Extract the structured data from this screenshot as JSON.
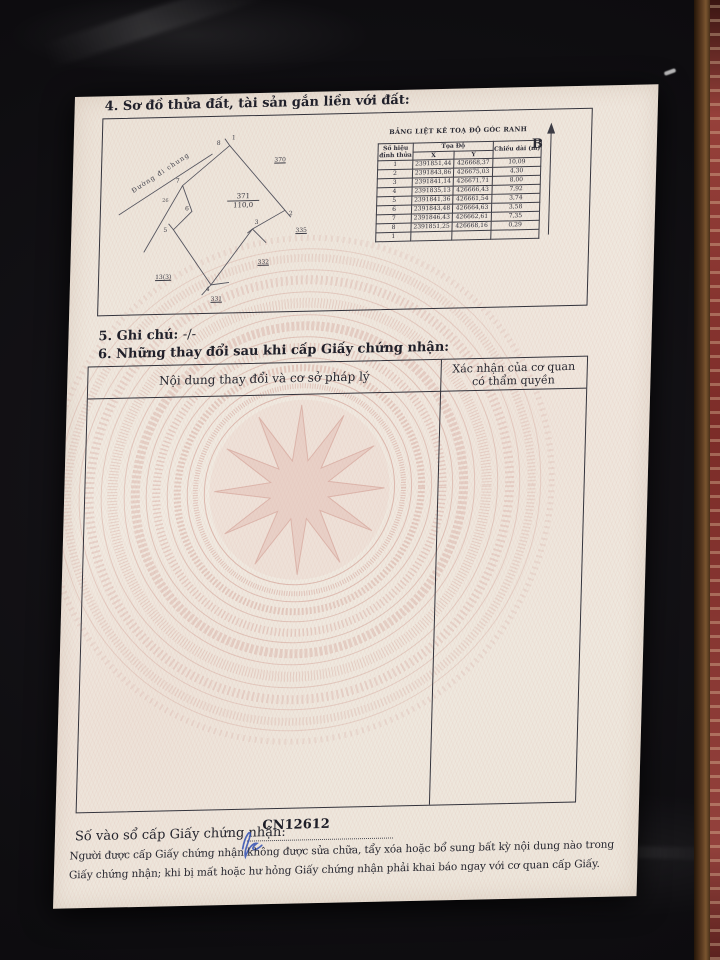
{
  "page": {
    "section4_title": "4. Sơ đồ thửa đất, tài sản gắn liền với đất:",
    "section5_label": "5. Ghi chú:",
    "section5_value": "-/-",
    "section6_title": "6. Những thay đổi sau khi cấp Giấy chứng nhận:"
  },
  "diagram": {
    "road_label": "Đường đi chung",
    "parcel_number": "371",
    "parcel_area": "110,0",
    "north_label": "B",
    "small_note": "26",
    "vertices": [
      "1",
      "2",
      "3",
      "4",
      "5",
      "6",
      "7",
      "8"
    ],
    "neighbors": [
      "370",
      "335",
      "332",
      "331",
      "13(3)"
    ]
  },
  "coord_table": {
    "title": "BẢNG LIỆT KÊ TOẠ ĐỘ GÓC RANH",
    "col_vertex_line1": "Số hiệu",
    "col_vertex_line2": "đỉnh thửa",
    "col_coords": "Tọa Độ",
    "col_x": "X",
    "col_y": "Y",
    "col_length": "Chiều dài (m)",
    "rows": [
      [
        "1",
        "2391851,44",
        "426668,37",
        "10,09"
      ],
      [
        "2",
        "2391843,86",
        "426675,03",
        "4,30"
      ],
      [
        "3",
        "2391841,14",
        "426671,71",
        "8,00"
      ],
      [
        "4",
        "2391835,13",
        "426666,43",
        "7,92"
      ],
      [
        "5",
        "2391841,36",
        "426661,54",
        "3,74"
      ],
      [
        "6",
        "2391843,48",
        "426664,63",
        "3,58"
      ],
      [
        "7",
        "2391846,43",
        "426662,61",
        "7,35"
      ],
      [
        "8",
        "2391851,25",
        "426668,16",
        "0,29"
      ],
      [
        "1",
        "",
        "",
        ""
      ]
    ]
  },
  "changes_table": {
    "col1_header": "Nội dung thay đổi và cơ sở pháp lý",
    "col2_header_line1": "Xác nhận của cơ quan",
    "col2_header_line2": "có thẩm quyền"
  },
  "footer": {
    "register_label": "Số vào sổ cấp Giấy chứng nhận:",
    "register_number": "CN12612",
    "notice_line1": "Người được cấp Giấy chứng nhận không được sửa chữa, tẩy xóa hoặc bổ sung bất kỳ nội dung nào trong",
    "notice_line2": "Giấy chứng nhận; khi bị mất hoặc hư hỏng Giấy chứng nhận phải khai báo ngay với cơ quan cấp Giấy."
  },
  "colors": {
    "paper": "#efe8df",
    "watermark_pink": "#c98b80",
    "ink": "#23232c",
    "pen_blue": "#3a57b5",
    "table_black": "#111014",
    "wood_edge": "#6b4a2e",
    "carpet_red": "#8c3431"
  }
}
